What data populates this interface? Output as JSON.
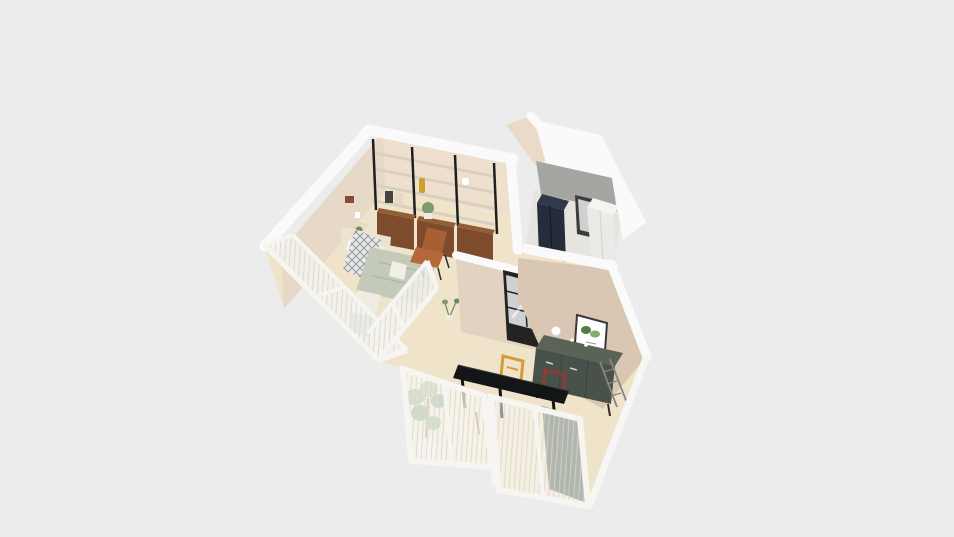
{
  "scene": {
    "description": "Isometric 3D floor-plan render of a small apartment, viewed from above on a plain light-gray background",
    "rooms": [
      {
        "name": "living-bedroom",
        "items": [
          "black metal wall shelving with four shelf levels",
          "walnut drawer cabinets under shelving",
          "three corner wall shelves with decor",
          "platform bed with headboard and pillows",
          "patterned throw blanket",
          "sage duvet",
          "white nightstand",
          "white foot bench",
          "cognac leather sling chair",
          "glazed window walls with sheer curtains"
        ]
      },
      {
        "name": "utility-room",
        "items": [
          "gray concrete feature wall",
          "navy two-door refrigerator",
          "small dark-framed window",
          "tall white cabinet"
        ]
      },
      {
        "name": "kitchen-dining",
        "items": [
          "black steel-framed interior window",
          "white half counter with red vase",
          "small floor plant",
          "dark green sideboard counter",
          "white kettle",
          "framed botanical print",
          "metal drying rack",
          "black dining table",
          "orange square-frame chair",
          "maroon square-frame chair",
          "tall potted plant",
          "two sliding windows with sheer curtains",
          "dark green curtain panel"
        ]
      }
    ],
    "colors": {
      "background": "#ececec",
      "floor": "#efe3c9",
      "floor_edge": "#f6f6f4",
      "floor_utility": "#e6e4df",
      "wall_white": "#fafafa",
      "wall_beige": "#e7d9c7",
      "wall_beige_light": "#eee0cd",
      "wall_jog": "#e9dbc8",
      "wall_tan": "#d9c6b3",
      "wall_steel_face": "#e2d3c1",
      "wall_gray": "#a5a5a2",
      "shelf_metal": "#1f1f1f",
      "shelf_board": "#d8d1c2",
      "shelf_corner": "#e6dac2",
      "drawer_wood": "#7e4c2c",
      "drawer_wood_top": "#935d36",
      "bed_frame": "#ece4d2",
      "pillow": "#f7f4ec",
      "pillow2": "#f3efe6",
      "throw_base": "#e8e8e6",
      "throw_line": "#8f969e",
      "throw_gray": "#b6bcb0",
      "duvet": "#c3cab9",
      "duvet_fold": "#aeb6a6",
      "bench": "#efece1",
      "nightstand": "#f2efe8",
      "chair_cognac": "#b5693a",
      "chair_cognac_dark": "#a85f33",
      "chair_leg": "#2e2a26",
      "counter_white": "#f4f2ec",
      "counter_white_top": "#fbfaf6",
      "vase_red": "#b8402e",
      "steel_frame": "#232321",
      "glass": "#cdd1d1",
      "glare": "#ffffff",
      "window_white": "#f6f5f1",
      "curtain_dark": "#5a675a",
      "curtain_dark_line": "#49544a",
      "counter_green_top": "#5a6456",
      "counter_green_front": "#49524a",
      "counter_seam": "#3a423c",
      "handle_light": "#cfcfc9",
      "table_black": "#141517",
      "table_edge": "#3c3c40",
      "chair_orange": "#d79a3c",
      "chair_maroon": "#8e3b33",
      "plant_green": "#7f9b6e",
      "plant_green_dark": "#6d8a5c",
      "plant_green_light": "#93ac7f",
      "pot_white": "#eceae4",
      "trunk": "#7a6a4f",
      "fridge_navy": "#252c3a",
      "fridge_navy_top": "#323949",
      "fridge_seam": "#141a26",
      "cabinet_white": "#eceae6",
      "cabinet_white_top": "#f5f4f0",
      "cabinet_seam": "#d4d2cd",
      "window_gray_frame": "#3c3c3a",
      "print_frame": "#3a3a38",
      "print_green_dark": "#4e7d46",
      "print_green_light": "#7fae6a",
      "print_text": "#999999",
      "rack_gray": "#8a857c",
      "mustard": "#c9a227",
      "book_red": "#8a4a3a",
      "decor_dark": "#444444",
      "decor_white": "#ffffff"
    }
  }
}
